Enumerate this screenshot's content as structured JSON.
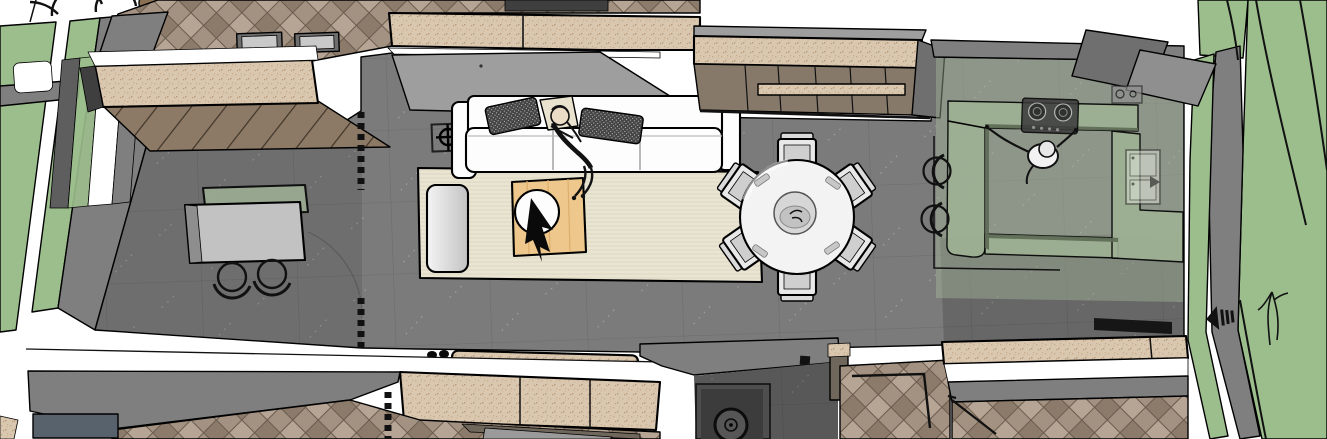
{
  "app": {
    "name": "3d-floorplan-viewport",
    "description": "Top-down 3D architectural render of an apartment: terrace, living room, dining area, kitchen and adjoining bedrooms"
  },
  "colors": {
    "outline": "#000000",
    "ink": "#111111",
    "white": "#FFFFFF",
    "grass": "#9CBE8D",
    "wall": "#7F7F7F",
    "wallL": "#9E9E9E",
    "wallD": "#5E5E5E",
    "wallXD": "#3F3F3F",
    "floor": "#7B7B7B",
    "grout": "#6C6C6C",
    "speck": "#DAC7AF",
    "speckD1": "#C9AE8E",
    "speckD2": "#B89878",
    "wood": "#A39282",
    "woodD": "#8C7B6B",
    "woodL": "#B6A595",
    "woodLine": "#6A5B4C",
    "deck": "#8C7A66",
    "deckLine": "#3F3428",
    "rug": "#EAE5D3",
    "rugLine": "#DCD6C1",
    "sofa": "#FDFDFD",
    "sofaEdge": "#D8D8D8",
    "pillow": "#454545",
    "pillowDot": "#BFBFBF",
    "cream": "#E8E2CF",
    "skin": "#EADCC6",
    "ctable": "#EEC78D",
    "ctableLine": "#DCAD6B",
    "sage": "#9FB295",
    "sageD": "#5D6A55",
    "glass": "#A9BC9D",
    "taupe": "#867969",
    "taupeD": "#6F665C",
    "navy": "#57626C",
    "steel": "#3A3A3A",
    "dining": "#F3F3F3",
    "chair": "#E9E9E9",
    "chairD": "#CFCFCF",
    "bowl": "#D7D7D7",
    "ott1": "#F4F4F4",
    "ott2": "#C3C3C3"
  },
  "scene": {
    "rooms": [
      "top-bedroom",
      "terrace",
      "living-room",
      "dining-area",
      "kitchen",
      "hallway",
      "bottom-left-bedroom",
      "bottom-right-bedroom"
    ],
    "furniture": [
      "outdoor-table",
      "outdoor-chairs",
      "area-rug",
      "sofa",
      "throw-pillows",
      "coffee-table",
      "side-table",
      "tv-wall-cabinet",
      "dining-table",
      "dining-chairs",
      "centerpiece-bowl",
      "kitchen-counter",
      "cooktop",
      "kitchen-sink",
      "bar-stools",
      "washing-machine",
      "curtains",
      "floor-symbols"
    ],
    "people": [
      "person-lying-on-sofa",
      "person-cooking-in-kitchen"
    ],
    "exterior": [
      "lawn",
      "garden-paths",
      "tree",
      "shrub",
      "hose-bib-symbol"
    ]
  }
}
